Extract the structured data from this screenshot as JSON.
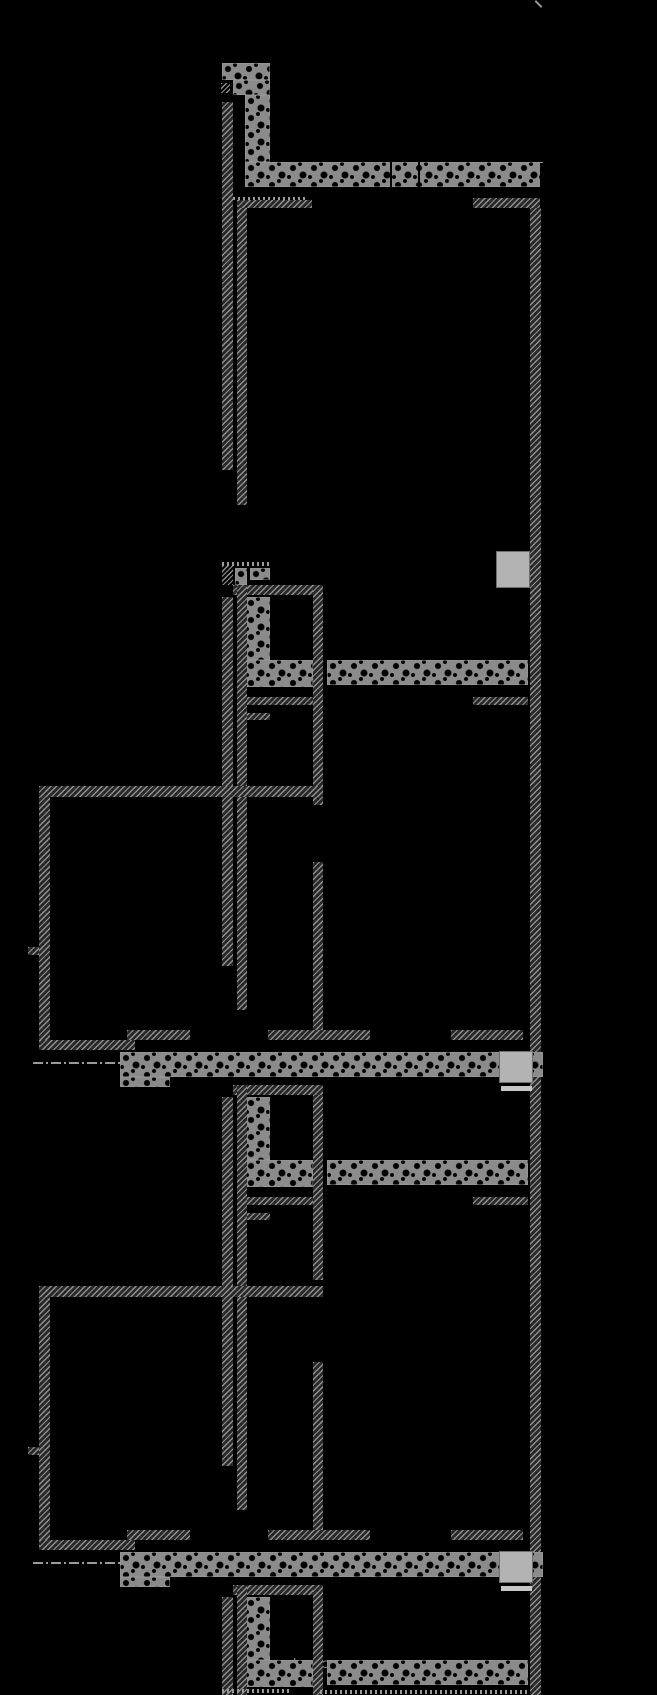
{
  "drawing": {
    "title": "building-section-drawing",
    "background_color": "#000000",
    "line_color": "#8f8f8f",
    "rubble_fill_color": "#8b8b8b",
    "bright_block_color": "#b3b3b3",
    "annotation": {
      "label": "balanel microzone"
    },
    "elements": [
      {
        "name": "north-tick",
        "kind": "tick",
        "x": 534,
        "y": 3,
        "w": 9,
        "h": 2
      },
      {
        "name": "rubble-pier-top-block-upper",
        "kind": "rubble",
        "x": 222,
        "y": 63,
        "w": 48,
        "h": 17
      },
      {
        "name": "rubble-pier-top-block-lower",
        "kind": "rubble",
        "x": 233,
        "y": 80,
        "w": 37,
        "h": 15
      },
      {
        "name": "rubble-pier-unit1",
        "kind": "rubble",
        "x": 245,
        "y": 95,
        "w": 25,
        "h": 67
      },
      {
        "name": "slab-band-unit1",
        "kind": "rubble",
        "x": 245,
        "y": 162,
        "w": 298,
        "h": 25
      },
      {
        "name": "slab-joint-1",
        "kind": "joint",
        "x": 390,
        "y": 162,
        "w": 2,
        "h": 25
      },
      {
        "name": "slab-joint-2",
        "kind": "joint",
        "x": 418,
        "y": 162,
        "w": 2,
        "h": 25
      },
      {
        "name": "slab-end-joint",
        "kind": "joint",
        "x": 540,
        "y": 163,
        "w": 3,
        "h": 24
      },
      {
        "name": "survey-mark-unit1",
        "kind": "mark",
        "x": 221,
        "y": 83,
        "w": 9,
        "h": 10
      },
      {
        "name": "dotted-edge-unit1",
        "kind": "dotted",
        "x": 233,
        "y": 197,
        "w": 74,
        "h": 3
      },
      {
        "name": "outer-wall-left-seg1",
        "kind": "hatch",
        "x": 222,
        "y": 102,
        "w": 11,
        "h": 368
      },
      {
        "name": "inner-wall-left-seg1",
        "kind": "hatch",
        "x": 237,
        "y": 200,
        "w": 10,
        "h": 305
      },
      {
        "name": "partition-top-left",
        "kind": "hatch",
        "x": 238,
        "y": 200,
        "w": 74,
        "h": 8
      },
      {
        "name": "partition-top-right",
        "kind": "hatch",
        "x": 473,
        "y": 198,
        "w": 67,
        "h": 10
      },
      {
        "name": "outer-wall-right",
        "kind": "hatch",
        "x": 530,
        "y": 208,
        "w": 11,
        "h": 1487
      },
      {
        "name": "door-dashes-unit2",
        "kind": "dotted",
        "x": 222,
        "y": 562,
        "w": 50,
        "h": 4
      },
      {
        "name": "survey-mark-unit2",
        "kind": "mark",
        "x": 222,
        "y": 566,
        "w": 11,
        "h": 19
      },
      {
        "name": "window-block-unit2-a",
        "kind": "rubble",
        "x": 235,
        "y": 568,
        "w": 12,
        "h": 17
      },
      {
        "name": "window-block-unit2-b",
        "kind": "rubble",
        "x": 250,
        "y": 568,
        "w": 20,
        "h": 12
      },
      {
        "name": "partition-unit2-top",
        "kind": "hatch",
        "x": 233,
        "y": 585,
        "w": 90,
        "h": 10
      },
      {
        "name": "corridor-wall-unit2-upper",
        "kind": "hatch",
        "x": 313,
        "y": 585,
        "w": 10,
        "h": 220
      },
      {
        "name": "corridor-wall-unit2-lower",
        "kind": "hatch",
        "x": 313,
        "y": 862,
        "w": 10,
        "h": 168
      },
      {
        "name": "rubble-pier-unit2",
        "kind": "rubble",
        "x": 245,
        "y": 597,
        "w": 25,
        "h": 63
      },
      {
        "name": "stair-band-unit2-left",
        "kind": "rubble",
        "x": 245,
        "y": 660,
        "w": 68,
        "h": 27
      },
      {
        "name": "stair-band-unit2-right",
        "kind": "rubble",
        "x": 327,
        "y": 660,
        "w": 201,
        "h": 25
      },
      {
        "name": "partition-unit2-mid",
        "kind": "hatch",
        "x": 237,
        "y": 697,
        "w": 76,
        "h": 8
      },
      {
        "name": "lintel-right-unit2",
        "kind": "hatch",
        "x": 473,
        "y": 697,
        "w": 55,
        "h": 8
      },
      {
        "name": "partition-unit2-small",
        "kind": "hatch",
        "x": 237,
        "y": 713,
        "w": 33,
        "h": 7
      },
      {
        "name": "outer-wall-left-seg2",
        "kind": "hatch",
        "x": 222,
        "y": 597,
        "w": 11,
        "h": 369
      },
      {
        "name": "inner-wall-left-seg2",
        "kind": "hatch",
        "x": 237,
        "y": 585,
        "w": 10,
        "h": 425
      },
      {
        "name": "room1-top-wall",
        "kind": "hatch",
        "x": 39,
        "y": 786,
        "w": 284,
        "h": 11
      },
      {
        "name": "room1-left-wall",
        "kind": "hatch",
        "x": 39,
        "y": 797,
        "w": 11,
        "h": 253
      },
      {
        "name": "room1-wall-tick",
        "kind": "hatch",
        "x": 28,
        "y": 947,
        "w": 11,
        "h": 8
      },
      {
        "name": "room1-bottom-wall-left",
        "kind": "hatch",
        "x": 40,
        "y": 1040,
        "w": 95,
        "h": 10
      },
      {
        "name": "room1-bottom-wall-step",
        "kind": "hatch",
        "x": 127,
        "y": 1030,
        "w": 63,
        "h": 10
      },
      {
        "name": "floor-wall-mid-1",
        "kind": "hatch",
        "x": 268,
        "y": 1030,
        "w": 102,
        "h": 10
      },
      {
        "name": "floor-wall-right-1",
        "kind": "hatch",
        "x": 451,
        "y": 1030,
        "w": 72,
        "h": 10
      },
      {
        "name": "axis-dashdot-1",
        "kind": "dashdot",
        "x": 33,
        "y": 1062,
        "w": 87,
        "h": 2
      },
      {
        "name": "floor-slab-band-1",
        "kind": "rubble",
        "x": 120,
        "y": 1052,
        "w": 423,
        "h": 25
      },
      {
        "name": "floor-slab-band-1-heel",
        "kind": "rubble",
        "x": 120,
        "y": 1077,
        "w": 50,
        "h": 10
      },
      {
        "name": "bright-block-wall",
        "kind": "bright",
        "x": 496,
        "y": 551,
        "w": 34,
        "h": 37
      },
      {
        "name": "bright-block-slab1",
        "kind": "bright",
        "x": 499,
        "y": 1051,
        "w": 34,
        "h": 32
      },
      {
        "name": "bright-strip-slab1",
        "kind": "strip",
        "x": 501,
        "y": 1086,
        "w": 31,
        "h": 5
      },
      {
        "name": "partition-unit3-top",
        "kind": "hatch",
        "x": 233,
        "y": 1085,
        "w": 90,
        "h": 10
      },
      {
        "name": "corridor-wall-unit3-upper",
        "kind": "hatch",
        "x": 313,
        "y": 1095,
        "w": 10,
        "h": 185
      },
      {
        "name": "corridor-wall-unit3-lower",
        "kind": "hatch",
        "x": 313,
        "y": 1362,
        "w": 10,
        "h": 168
      },
      {
        "name": "rubble-pier-unit3",
        "kind": "rubble",
        "x": 245,
        "y": 1097,
        "w": 25,
        "h": 63
      },
      {
        "name": "stair-band-unit3-left",
        "kind": "rubble",
        "x": 245,
        "y": 1160,
        "w": 68,
        "h": 27
      },
      {
        "name": "stair-band-unit3-right",
        "kind": "rubble",
        "x": 327,
        "y": 1160,
        "w": 201,
        "h": 25
      },
      {
        "name": "partition-unit3-mid",
        "kind": "hatch",
        "x": 237,
        "y": 1197,
        "w": 76,
        "h": 8
      },
      {
        "name": "lintel-right-unit3",
        "kind": "hatch",
        "x": 473,
        "y": 1197,
        "w": 55,
        "h": 8
      },
      {
        "name": "partition-unit3-small",
        "kind": "hatch",
        "x": 237,
        "y": 1213,
        "w": 33,
        "h": 7
      },
      {
        "name": "outer-wall-left-seg3",
        "kind": "hatch",
        "x": 222,
        "y": 1097,
        "w": 11,
        "h": 369
      },
      {
        "name": "inner-wall-left-seg3",
        "kind": "hatch",
        "x": 237,
        "y": 1085,
        "w": 10,
        "h": 425
      },
      {
        "name": "room2-top-wall",
        "kind": "hatch",
        "x": 39,
        "y": 1286,
        "w": 284,
        "h": 11
      },
      {
        "name": "room2-left-wall",
        "kind": "hatch",
        "x": 39,
        "y": 1297,
        "w": 11,
        "h": 253
      },
      {
        "name": "room2-wall-tick",
        "kind": "hatch",
        "x": 28,
        "y": 1447,
        "w": 11,
        "h": 8
      },
      {
        "name": "room2-bottom-wall-left",
        "kind": "hatch",
        "x": 40,
        "y": 1540,
        "w": 95,
        "h": 10
      },
      {
        "name": "room2-bottom-wall-step",
        "kind": "hatch",
        "x": 127,
        "y": 1530,
        "w": 63,
        "h": 10
      },
      {
        "name": "floor-wall-mid-2",
        "kind": "hatch",
        "x": 268,
        "y": 1530,
        "w": 102,
        "h": 10
      },
      {
        "name": "floor-wall-right-2",
        "kind": "hatch",
        "x": 451,
        "y": 1530,
        "w": 72,
        "h": 10
      },
      {
        "name": "axis-dashdot-2",
        "kind": "dashdot",
        "x": 33,
        "y": 1562,
        "w": 87,
        "h": 2
      },
      {
        "name": "floor-slab-band-2",
        "kind": "rubble",
        "x": 120,
        "y": 1552,
        "w": 423,
        "h": 25
      },
      {
        "name": "floor-slab-band-2-heel",
        "kind": "rubble",
        "x": 120,
        "y": 1577,
        "w": 50,
        "h": 10
      },
      {
        "name": "bright-block-slab2",
        "kind": "bright",
        "x": 499,
        "y": 1551,
        "w": 34,
        "h": 32
      },
      {
        "name": "bright-strip-slab2",
        "kind": "strip",
        "x": 501,
        "y": 1586,
        "w": 31,
        "h": 5
      },
      {
        "name": "partition-unit4-top",
        "kind": "hatch",
        "x": 233,
        "y": 1585,
        "w": 90,
        "h": 10
      },
      {
        "name": "corridor-wall-unit4",
        "kind": "hatch",
        "x": 313,
        "y": 1585,
        "w": 10,
        "h": 110
      },
      {
        "name": "rubble-pier-unit4",
        "kind": "rubble",
        "x": 245,
        "y": 1597,
        "w": 25,
        "h": 63
      },
      {
        "name": "stair-band-unit4-left",
        "kind": "rubble",
        "x": 245,
        "y": 1660,
        "w": 68,
        "h": 27
      },
      {
        "name": "stair-band-unit4-right",
        "kind": "rubble",
        "x": 327,
        "y": 1660,
        "w": 201,
        "h": 25
      },
      {
        "name": "outer-wall-left-seg4",
        "kind": "hatch",
        "x": 222,
        "y": 1597,
        "w": 11,
        "h": 98
      },
      {
        "name": "inner-wall-left-seg4",
        "kind": "hatch",
        "x": 237,
        "y": 1585,
        "w": 10,
        "h": 110
      },
      {
        "name": "dotted-edge-bottom-left",
        "kind": "dotted",
        "x": 222,
        "y": 1689,
        "w": 70,
        "h": 4
      },
      {
        "name": "dotted-edge-bottom-right",
        "kind": "dotted",
        "x": 320,
        "y": 1690,
        "w": 210,
        "h": 4
      }
    ]
  }
}
